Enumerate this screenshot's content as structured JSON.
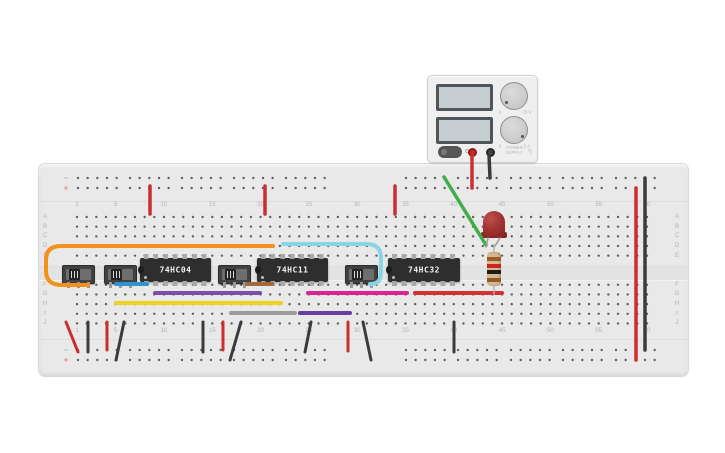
{
  "power_supply": {
    "off_label": "OFF",
    "brand_line1": "POWER",
    "brand_line2": "SUPPLY",
    "bolt_icon": "ϟ",
    "display_top": "",
    "display_bottom": "",
    "voltage_knob": {
      "min": "0",
      "max": "30 V"
    },
    "current_knob": {
      "min": "0",
      "max": "5 A"
    }
  },
  "breadboard": {
    "column_numbers": [
      "1",
      "5",
      "10",
      "15",
      "20",
      "25",
      "30",
      "35",
      "40",
      "45",
      "50",
      "55",
      "60"
    ],
    "row_letters_top": [
      "A",
      "B",
      "C",
      "D",
      "E"
    ],
    "row_letters_bottom": [
      "F",
      "G",
      "H",
      "I",
      "J"
    ],
    "neg_symbol": "−",
    "pos_symbol": "+"
  },
  "components": {
    "ics": [
      {
        "label": "74HC04"
      },
      {
        "label": "74HC11"
      },
      {
        "label": "74HC32"
      }
    ],
    "led": {
      "color": "red"
    },
    "resistor": {
      "band_colors": [
        "#9a5a28",
        "#cc2222",
        "#1c1c1c",
        "#8a5a2a"
      ]
    }
  },
  "wires": [
    {
      "name": "supply-positive-lead",
      "color": "#c92f2f",
      "width": 3.5,
      "points": [
        [
          472,
          155
        ],
        [
          472,
          188
        ]
      ]
    },
    {
      "name": "supply-negative-lead",
      "color": "#3b3b3b",
      "width": 3.5,
      "points": [
        [
          489,
          155
        ],
        [
          490,
          178
        ]
      ]
    },
    {
      "name": "rail-jumper-red-1",
      "color": "#c92f2f",
      "width": 3.5,
      "points": [
        [
          150,
          186
        ],
        [
          150,
          214
        ]
      ]
    },
    {
      "name": "rail-jumper-red-2",
      "color": "#c92f2f",
      "width": 3.5,
      "points": [
        [
          265,
          186
        ],
        [
          265,
          214
        ]
      ]
    },
    {
      "name": "rail-jumper-red-3",
      "color": "#c92f2f",
      "width": 3.5,
      "points": [
        [
          395,
          186
        ],
        [
          395,
          214
        ]
      ]
    },
    {
      "name": "green-wire",
      "color": "#3fae49",
      "width": 3.5,
      "points": [
        [
          444,
          177
        ],
        [
          486,
          245
        ]
      ]
    },
    {
      "name": "orange-wire",
      "color": "#f2911e",
      "width": 4,
      "path": "M 88 285 L 62 285 Q 46 285 46 271 L 46 260 Q 46 246 61 246 L 273 246"
    },
    {
      "name": "cyan-wire",
      "color": "#8ad4e8",
      "width": 4,
      "path": "M 283 244 L 366 244 Q 381 244 381 258 L 381 273 Q 381 284 370 284"
    },
    {
      "name": "blue-wire",
      "color": "#2f93d0",
      "width": 4,
      "points": [
        [
          116,
          284
        ],
        [
          147,
          284
        ]
      ]
    },
    {
      "name": "brown-wire",
      "color": "#a06a3a",
      "width": 4,
      "points": [
        [
          247,
          284
        ],
        [
          272,
          284
        ]
      ]
    },
    {
      "name": "purple-wire-g",
      "color": "#7a4fa8",
      "width": 4,
      "points": [
        [
          155,
          293
        ],
        [
          260,
          293
        ]
      ]
    },
    {
      "name": "magenta-wire",
      "color": "#db2491",
      "width": 4,
      "points": [
        [
          308,
          293
        ],
        [
          407,
          293
        ]
      ]
    },
    {
      "name": "red-wire-g",
      "color": "#d43030",
      "width": 4,
      "points": [
        [
          415,
          293
        ],
        [
          502,
          293
        ]
      ]
    },
    {
      "name": "yellow-wire",
      "color": "#eed21f",
      "width": 4,
      "points": [
        [
          116,
          303
        ],
        [
          281,
          303
        ]
      ]
    },
    {
      "name": "gray-wire",
      "color": "#9b9b9b",
      "width": 4,
      "points": [
        [
          231,
          313
        ],
        [
          295,
          313
        ]
      ]
    },
    {
      "name": "purple-wire-i",
      "color": "#6b3fa0",
      "width": 4,
      "points": [
        [
          300,
          313
        ],
        [
          350,
          313
        ]
      ]
    },
    {
      "name": "bottom-jumper-red-1",
      "color": "#c92f2f",
      "width": 3,
      "points": [
        [
          66,
          322
        ],
        [
          78,
          352
        ]
      ]
    },
    {
      "name": "bottom-jumper-black-1",
      "color": "#3b3b3b",
      "width": 3,
      "points": [
        [
          88,
          322
        ],
        [
          88,
          352
        ]
      ]
    },
    {
      "name": "bottom-jumper-red-2",
      "color": "#c92f2f",
      "width": 3,
      "points": [
        [
          107,
          322
        ],
        [
          107,
          350
        ]
      ]
    },
    {
      "name": "bottom-jumper-black-2",
      "color": "#3b3b3b",
      "width": 3,
      "points": [
        [
          124,
          322
        ],
        [
          116,
          360
        ]
      ]
    },
    {
      "name": "bottom-jumper-black-3",
      "color": "#3b3b3b",
      "width": 3,
      "points": [
        [
          203,
          322
        ],
        [
          203,
          352
        ]
      ]
    },
    {
      "name": "bottom-jumper-red-3",
      "color": "#c92f2f",
      "width": 3,
      "points": [
        [
          223,
          322
        ],
        [
          223,
          350
        ]
      ]
    },
    {
      "name": "bottom-jumper-black-4",
      "color": "#3b3b3b",
      "width": 3,
      "points": [
        [
          241,
          322
        ],
        [
          230,
          360
        ]
      ]
    },
    {
      "name": "bottom-jumper-black-5",
      "color": "#3b3b3b",
      "width": 3,
      "points": [
        [
          311,
          322
        ],
        [
          305,
          352
        ]
      ]
    },
    {
      "name": "bottom-jumper-red-4",
      "color": "#c92f2f",
      "width": 3,
      "points": [
        [
          348,
          322
        ],
        [
          348,
          351
        ]
      ]
    },
    {
      "name": "bottom-jumper-black-6",
      "color": "#3b3b3b",
      "width": 3,
      "points": [
        [
          363,
          322
        ],
        [
          371,
          360
        ]
      ]
    },
    {
      "name": "bottom-jumper-black-7",
      "color": "#3b3b3b",
      "width": 3,
      "points": [
        [
          454,
          322
        ],
        [
          454,
          352
        ]
      ]
    },
    {
      "name": "right-red-rail-wire",
      "color": "#c92f2f",
      "width": 3.5,
      "points": [
        [
          636,
          188
        ],
        [
          636,
          360
        ]
      ]
    },
    {
      "name": "right-black-rail-wire",
      "color": "#3b3b3b",
      "width": 3.5,
      "points": [
        [
          645,
          178
        ],
        [
          645,
          350
        ]
      ]
    },
    {
      "name": "led-lead-left",
      "color": "#9a9a9a",
      "width": 1.5,
      "points": [
        [
          488,
          238
        ],
        [
          486,
          247
        ]
      ]
    },
    {
      "name": "led-lead-right",
      "color": "#9a9a9a",
      "width": 1.5,
      "points": [
        [
          500,
          238
        ],
        [
          495,
          246
        ]
      ]
    },
    {
      "name": "resistor-lead-top",
      "color": "#b0b0b0",
      "width": 1.5,
      "points": [
        [
          494,
          245
        ],
        [
          494,
          253
        ]
      ]
    },
    {
      "name": "resistor-lead-bottom",
      "color": "#b0b0b0",
      "width": 1.5,
      "points": [
        [
          494,
          285
        ],
        [
          494,
          294
        ]
      ]
    }
  ]
}
